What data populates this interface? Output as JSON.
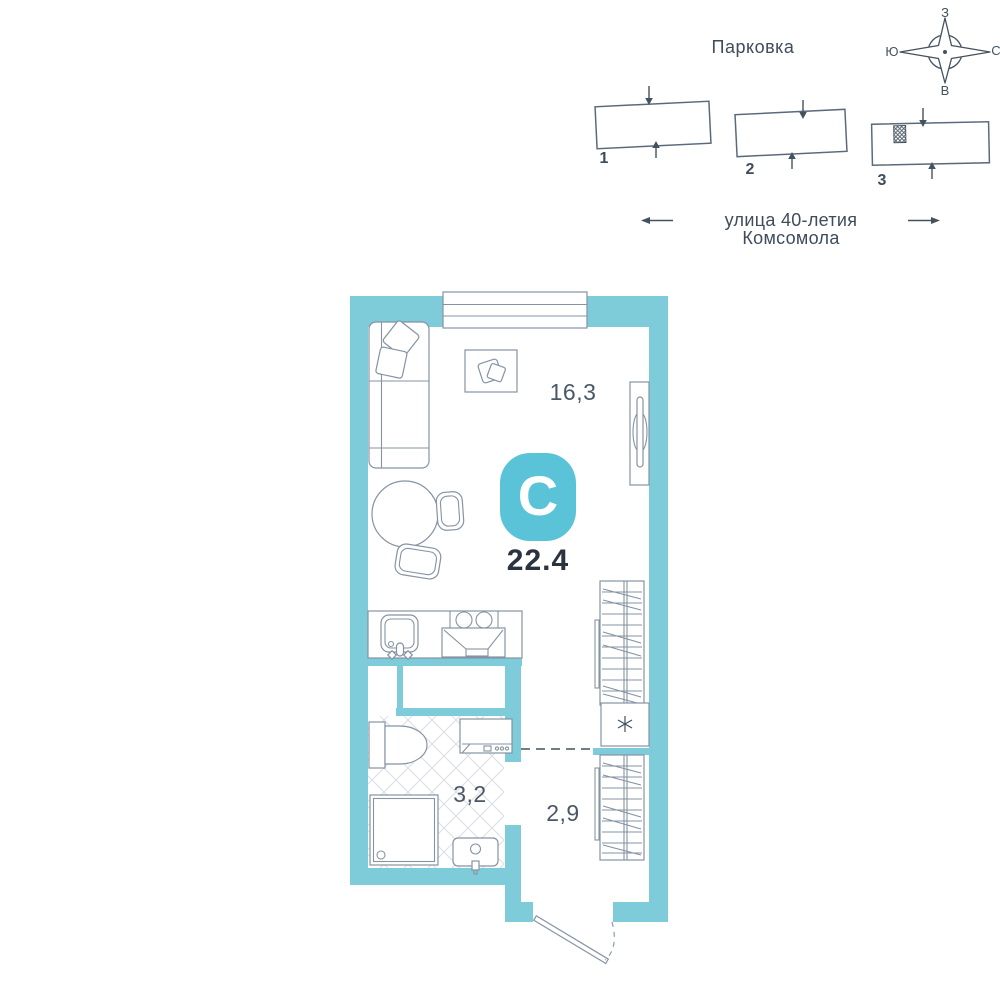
{
  "site_plan": {
    "title": "Парковка",
    "street": "улица 40-летия Комсомола",
    "buildings": [
      {
        "number": "1"
      },
      {
        "number": "2"
      },
      {
        "number": "3",
        "marker": "apartment-location-hatch"
      }
    ],
    "compass": {
      "top": "З",
      "bottom": "В",
      "left": "Ю",
      "right": "С"
    }
  },
  "apartment": {
    "type_letter": "С",
    "total_area": "22.4",
    "rooms": [
      {
        "name": "living-room",
        "area": "16,3"
      },
      {
        "name": "bathroom",
        "area": "3,2"
      },
      {
        "name": "hallway",
        "area": "2,9"
      }
    ]
  },
  "colors": {
    "wall": "#7ECBDA",
    "logo": "#5BC3D8",
    "furniture_outline": "#8593A3",
    "site_outline": "#5A6A7B",
    "dark_line": "#44525F",
    "area_text": "#4A5866",
    "total_text": "#2B333E",
    "tile_line": "#D9DEE4"
  },
  "icons": {
    "compass-rose-icon": "4-point star with circle, cyrillic cardinal letters",
    "location-hatch-icon": "crosshatched square on building 3",
    "down-arrow-icon": "entrance arrow",
    "up-arrow-icon": "entrance arrow",
    "left-arrow-icon": "street direction",
    "right-arrow-icon": "street direction",
    "boiler-icon": "square with six-ray asterisk",
    "window-icon": "triple-line window",
    "door-icon": "door leaf with dashed swing arc"
  }
}
